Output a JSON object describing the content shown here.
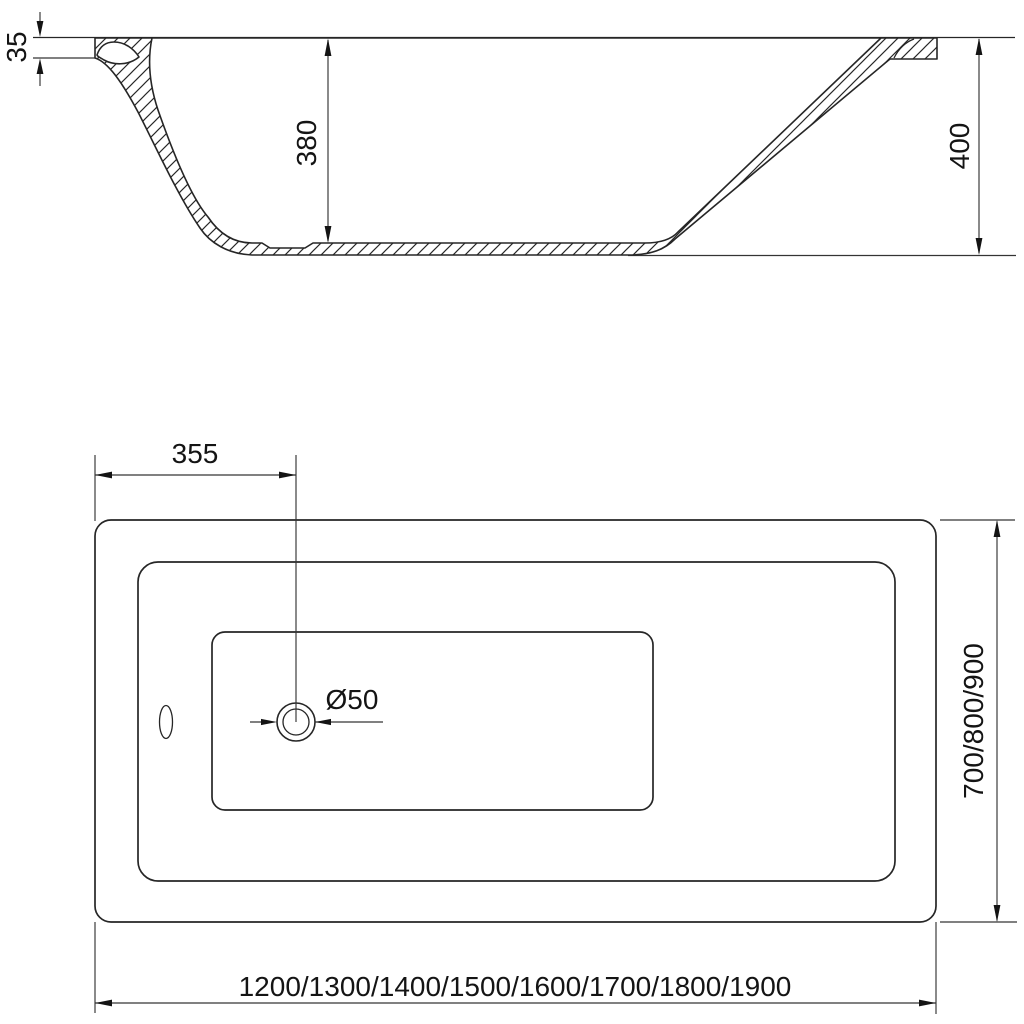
{
  "colors": {
    "background": "#ffffff",
    "object_line": "#262626",
    "dimension_line": "#343434",
    "text": "#141414"
  },
  "drawing": {
    "title": "bathtub technical drawing",
    "section_view": {
      "label": "side cross-section",
      "dims": {
        "rim_thickness": "35",
        "inner_depth": "380",
        "overall_height": "400"
      }
    },
    "plan_view": {
      "label": "top plan view",
      "dims": {
        "drain_offset": "355",
        "drain_diameter": "Ø50",
        "width_options": "700/800/900",
        "length_options": "1200/1300/1400/1500/1600/1700/1800/1900"
      }
    }
  }
}
